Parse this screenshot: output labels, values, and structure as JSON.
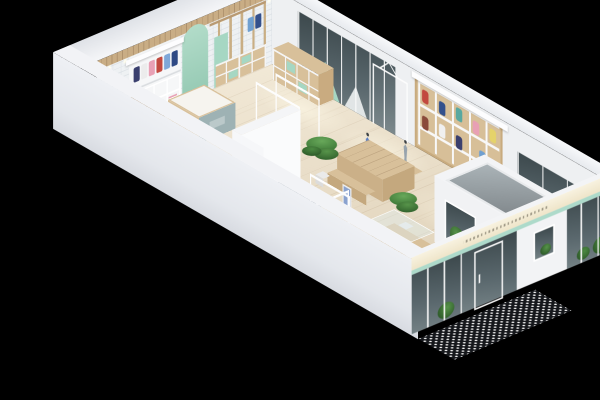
{
  "meta": {
    "title": "3D isometric cutaway floor plan of a clothing retail store",
    "view": "isometric bird's-eye render on black background",
    "background": "#000000"
  },
  "palette": {
    "background": "#000000",
    "floor_wood": "#e8dcc5",
    "plank_line": "#96764f",
    "wall_white": "#eef0f2",
    "outer_wall": "#e9ebef",
    "brick_line": "#d2d8de",
    "wood_light": "#d9c29c",
    "wood_mid": "#c9ad85",
    "mint_accent": "#a6d7c3",
    "teal_glass_strip": "#a0d6c4",
    "dark_glass": "#39454a",
    "skylight_gray": "#96a0a4",
    "sofa_gray": "#b7bfc7",
    "plant_green": "#4c8a42",
    "fascia_lit": "#f6efdb",
    "mosaic_dark": "#15171b",
    "mosaic_dot": "#f2f2f2",
    "counter_front": "#9eb2b4",
    "mannequin_dress_blue": "#5b7fc4"
  },
  "scene": {
    "labels": {
      "stage": "black backdrop around isometric store model",
      "floor": "light wood plank shop floor with warm light pools",
      "nw_wall": "back-left wall: white brick, wood beam band, spotlights, wood display frames, mint arch, clothing wall unit",
      "ne_wall": "back-right wall: dark glass window with mint triangles, white display frame, clothing grid shelf, display window with mannequin and plants",
      "facade": "storefront facade: lit cream fascia, teal glass strip, dark glazing with white mullions, plants behind glass, glass door",
      "sw_wall": "front-left blank white perimeter wall",
      "mosaic": "black and white mosaic tile entry apron outside storefront",
      "vestibule": "white entrance vestibule volume with sloped gray glass skylight and plant window",
      "stairs": "wood staircase in west corner",
      "counter": "cash counter: wood sides, white top, gray-teal front panel",
      "cubby": "low wood cubby shelf with mint boxes against back-right wall",
      "grid_shelf": "wall grid shelf stocked with colorful folded and hung garments",
      "clothes_unit": "back-left hanging clothes unit with canopy and folded stacks",
      "arch": "mint green arched wall feature",
      "sofa": "gray lounge sofa",
      "partition": "white L-shaped fitting-room partition",
      "table": "wood display table with two benches",
      "glass_stand": "glass-top wood display vitrine",
      "cabinet": "low wood display cabinet with white cube seat",
      "racks": "white open garment rail racks",
      "mannequins": "two display mannequins, one in a blue dress",
      "plants": "three potted green plants",
      "sign_stand": "freestanding blue sign board near sofa"
    },
    "counts": {
      "floor_plants": 3,
      "garment_racks": 5,
      "mannequins": 2,
      "benches": 2,
      "glazed_bays": 3
    }
  }
}
